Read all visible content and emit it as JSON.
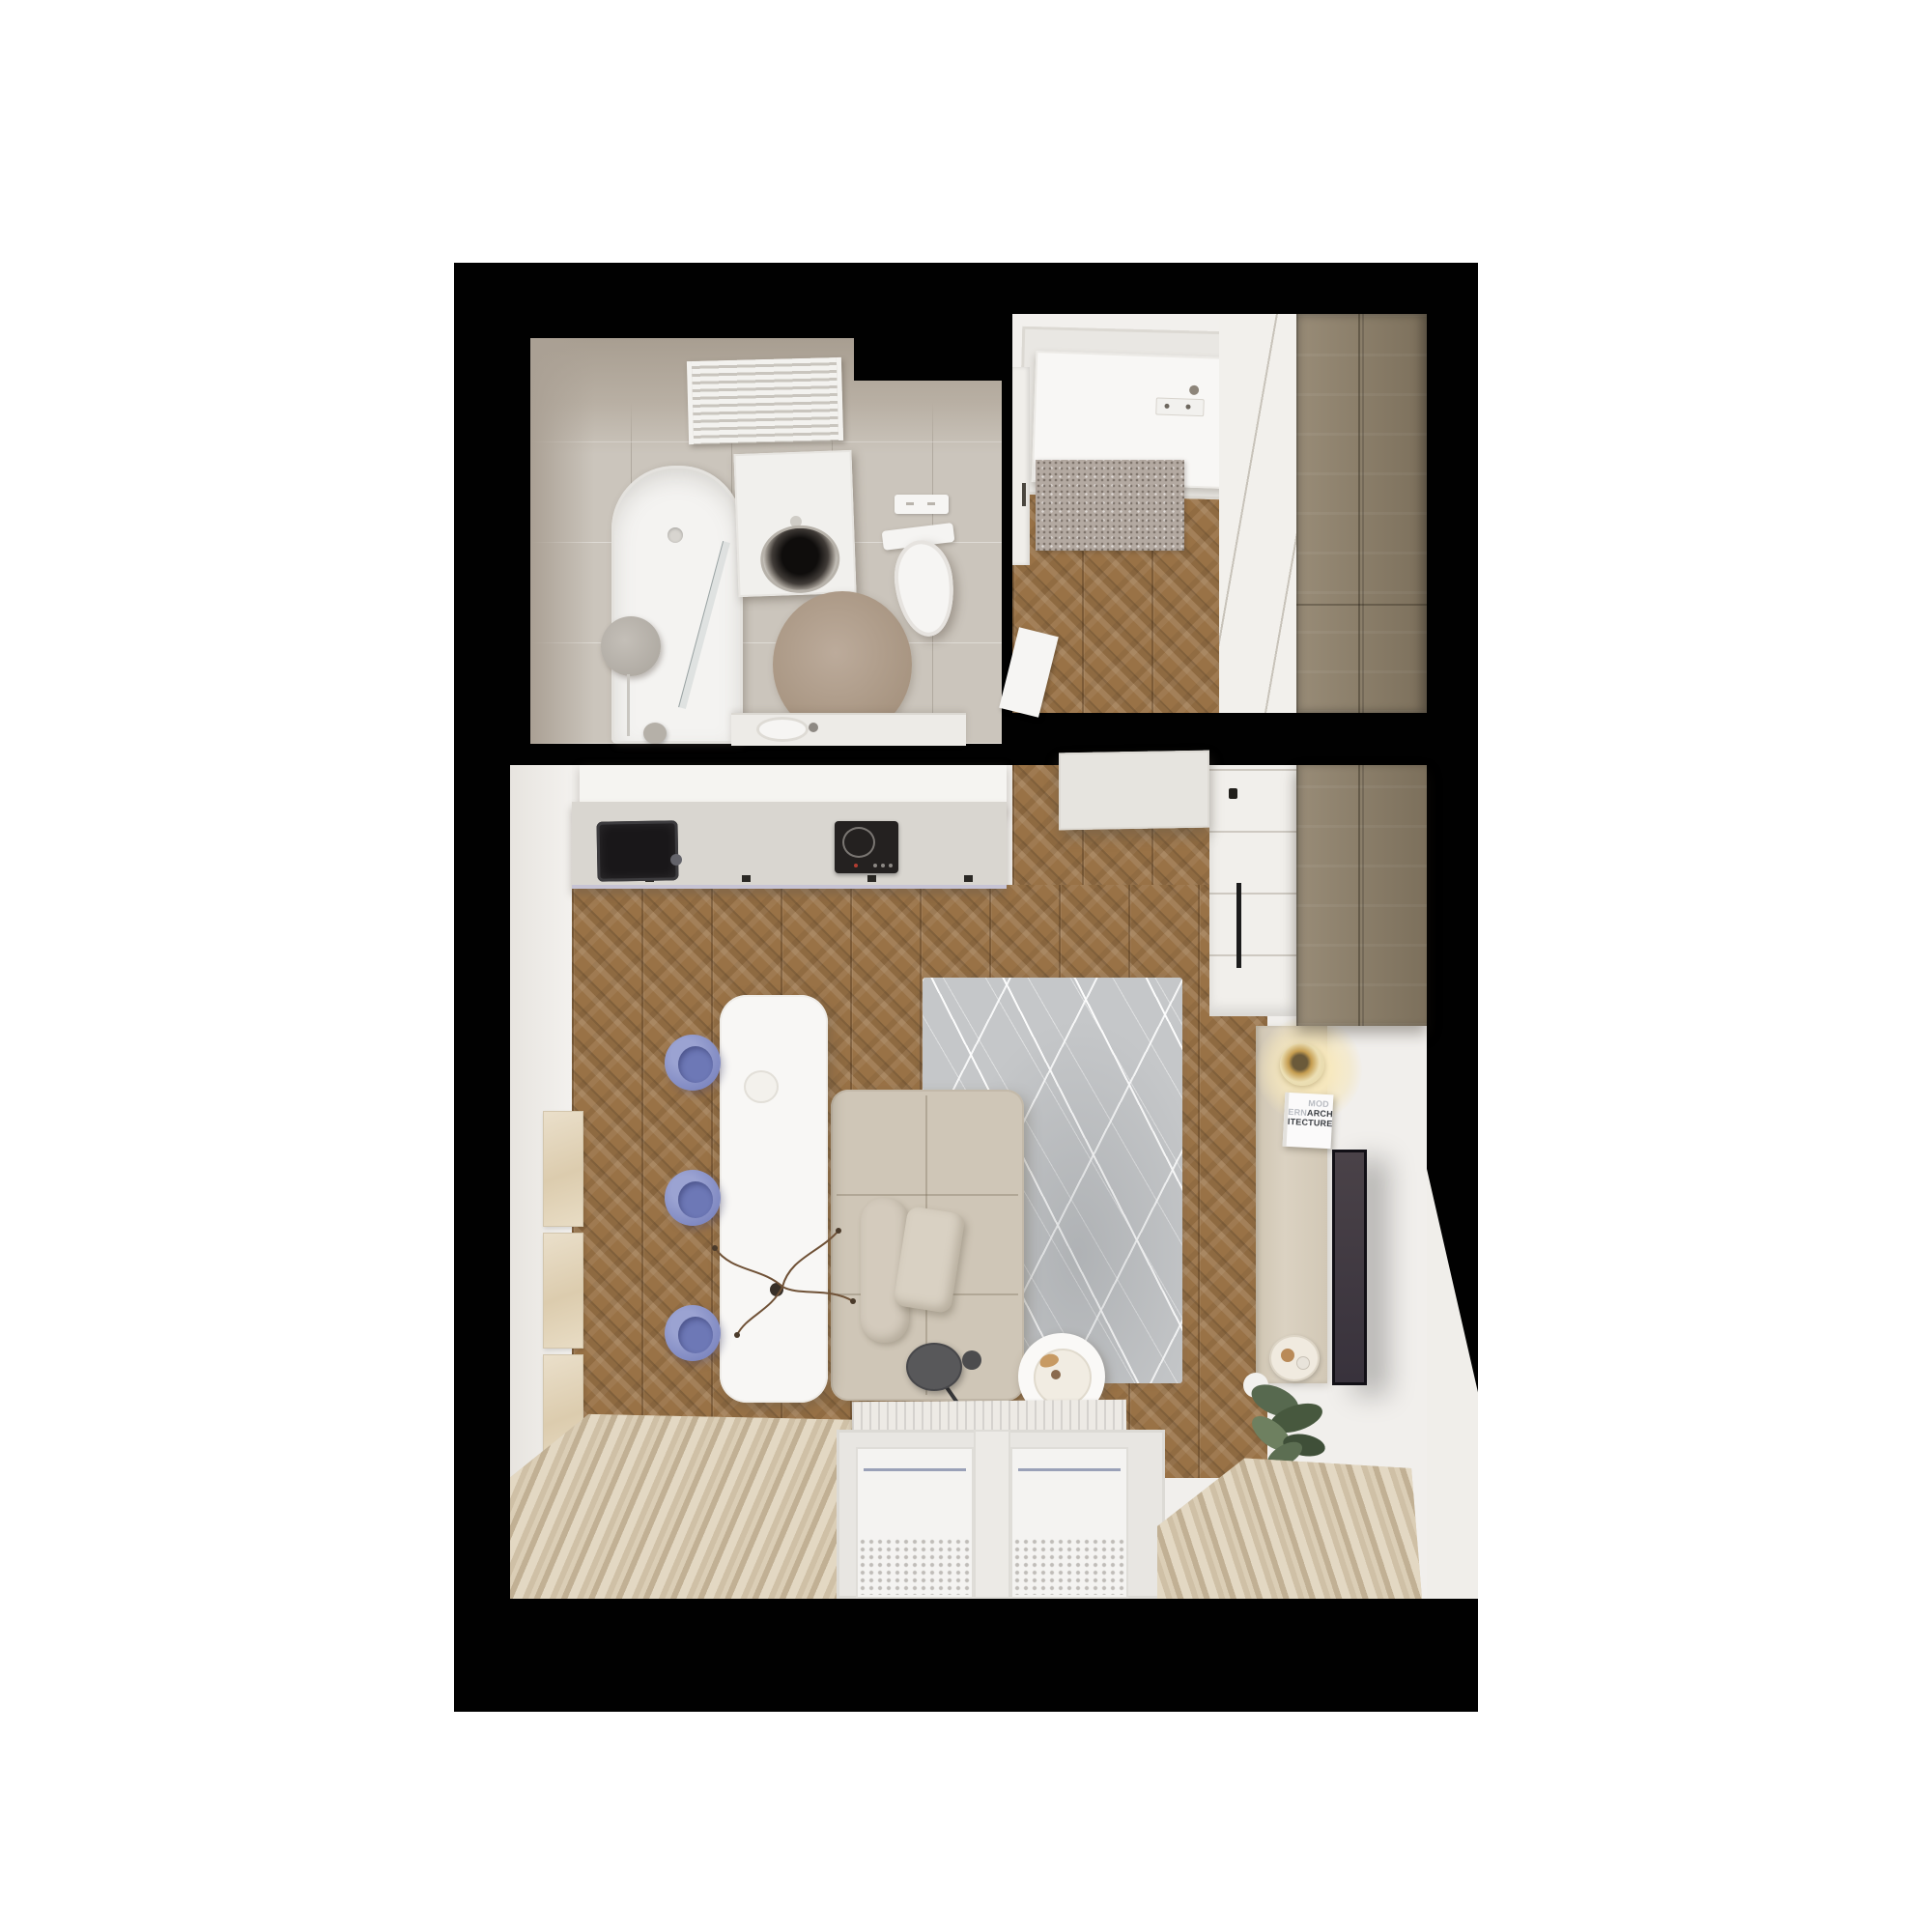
{
  "scene": {
    "type": "top-down 3D interior render of a studio apartment floor plan",
    "background_page": "#ffffff",
    "backdrop": "#010101",
    "rooms": [
      {
        "id": "bathroom",
        "position": "top-left",
        "floor": "light gray stone tile",
        "items": [
          "towel-radiator",
          "bathtub",
          "shower-glass-screen",
          "round-mirror",
          "washer-cabinet",
          "washing-machine-drum",
          "wall-hung-toilet",
          "flush-plate",
          "round-rug",
          "washbasin-counter",
          "washbasin"
        ]
      },
      {
        "id": "entry-hall",
        "position": "top-right",
        "floor": "chevron oak parquet",
        "items": [
          "entry-door",
          "peephole",
          "lock-plate",
          "shoe-cabinet",
          "doormat",
          "bathroom-door",
          "sliding-panel-wall",
          "tall-oak-wardrobe"
        ]
      },
      {
        "id": "living-kitchen",
        "position": "bottom",
        "floor": "chevron oak parquet",
        "items": [
          "kitchen-counter",
          "kitchen-sink",
          "induction-cooktop",
          "wall-art-triptych",
          "dining-island-table",
          "blue-stools-x3",
          "branch-centerpiece",
          "beige-modular-sofa",
          "throw-pillow",
          "gray-patterned-rug",
          "floor-lamp",
          "round-coffee-table",
          "travertine-sideboard",
          "table-lamp",
          "architecture-book",
          "serving-tray",
          "wall-mounted-tv",
          "potted-plant",
          "built-in-white-cabinets",
          "tall-oak-cabinet",
          "floating-cabinet",
          "left-curtain",
          "right-curtain",
          "radiator",
          "balcony-windows"
        ]
      }
    ]
  },
  "book_cover": {
    "title": "MODERN ARCHITECTURE",
    "lines": [
      {
        "light": "MOD",
        "dark": ""
      },
      {
        "light": "ERN",
        "dark": "ARCH"
      },
      {
        "light": "",
        "dark": "ITECTURE"
      }
    ]
  },
  "palette": {
    "page_white": "#ffffff",
    "backdrop_black": "#010101",
    "oak_floor": "#997246",
    "cabinet_oak": "#8d7f68",
    "bath_tile": "#cbc5bc",
    "wall_white": "#f1efec",
    "counter_gray": "#d9d6d0",
    "sink_black": "#191719",
    "stool_periwinkle": "#8790c6",
    "sofa_beige": "#cfc6b7",
    "rug_gray": "#c5c7c9",
    "curtain_beige": "#d4c6ad",
    "doormat_gray": "#b3a9a1",
    "tv_dark": "#3c353d",
    "lamp_gold": "#c59d50",
    "plant_green": "#57694f"
  }
}
